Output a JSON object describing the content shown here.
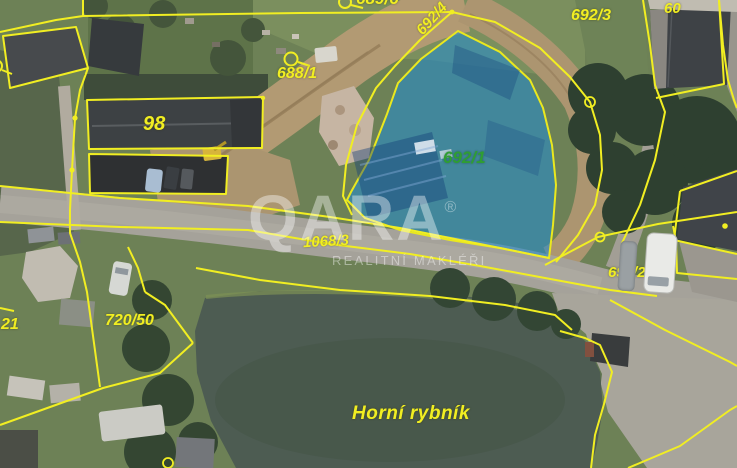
{
  "map": {
    "type": "cadastral-aerial-view",
    "boundary_color": "#f1ee22",
    "highlight": {
      "parcel": "692/1",
      "fill_color": "#2d94d4",
      "label_color": "#2f9e33"
    },
    "labels": {
      "top_clipped": "689/6",
      "l692_4": "692/4",
      "l692_3": "692/3",
      "l60": "60",
      "l688_1": "688/1",
      "l98": "98",
      "l692_1": "692/1",
      "l1068_3": "1068/3",
      "l692_2": "692/2",
      "l720_50": "720/50",
      "l21": "21",
      "pond": "Horní rybník"
    }
  },
  "watermark": {
    "brand": "QARA",
    "registered": "®",
    "tagline": "REALITNÍ MAKLÉŘI"
  }
}
